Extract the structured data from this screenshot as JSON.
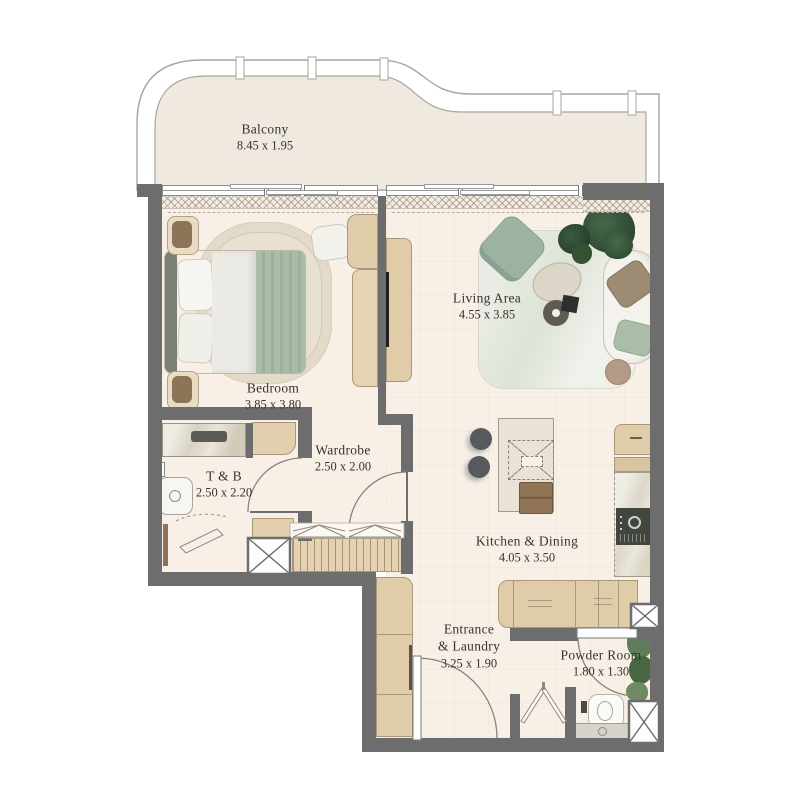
{
  "rooms": {
    "balcony": {
      "name": "Balcony",
      "dims": "8.45 x 1.95"
    },
    "bedroom": {
      "name": "Bedroom",
      "dims": "3.85 x 3.80"
    },
    "living": {
      "name": "Living Area",
      "dims": "4.55 x 3.85"
    },
    "wardrobe": {
      "name": "Wardrobe",
      "dims": "2.50 x 2.00"
    },
    "tb": {
      "name": "T & B",
      "dims": "2.50 x 2.20"
    },
    "kitchen": {
      "name": "Kitchen & Dining",
      "dims": "4.05 x 3.50"
    },
    "entrance": {
      "name": "Entrance",
      "name2": "& Laundry",
      "dims": "3.25 x 1.90"
    },
    "powder": {
      "name": "Powder Room",
      "dims": "1.80 x 1.30"
    }
  },
  "colors": {
    "wall": "#6d6d6d",
    "floor": "#f8f0e7",
    "balcony_floor": "#efe9e0",
    "cabinet_tan": "#e0cca9",
    "cabinet_border": "#a8977b",
    "accent_green": "#a9bda9",
    "sage_chair": "#9cb3a3",
    "appliance_dark": "#41463f",
    "marble": "#e9e4d8",
    "label_text": "#35342e",
    "thin_line": "#8f8a82"
  },
  "furniture": [
    "double-bed",
    "bedroom-rug",
    "nightstands",
    "pouf",
    "dresser",
    "tv",
    "living-rug",
    "armchair",
    "sofa",
    "coffee-table",
    "plants",
    "side-table",
    "kitchen-island",
    "bar-stools",
    "range-hood",
    "island-chair",
    "tall-cabinets",
    "oven-appliance",
    "base-counter",
    "entrance-cabinets",
    "shower",
    "bathroom-sink",
    "toilet",
    "powder-vanity",
    "wardrobe-hanging-rail",
    "bifold-laundry-doors",
    "service-shafts"
  ]
}
